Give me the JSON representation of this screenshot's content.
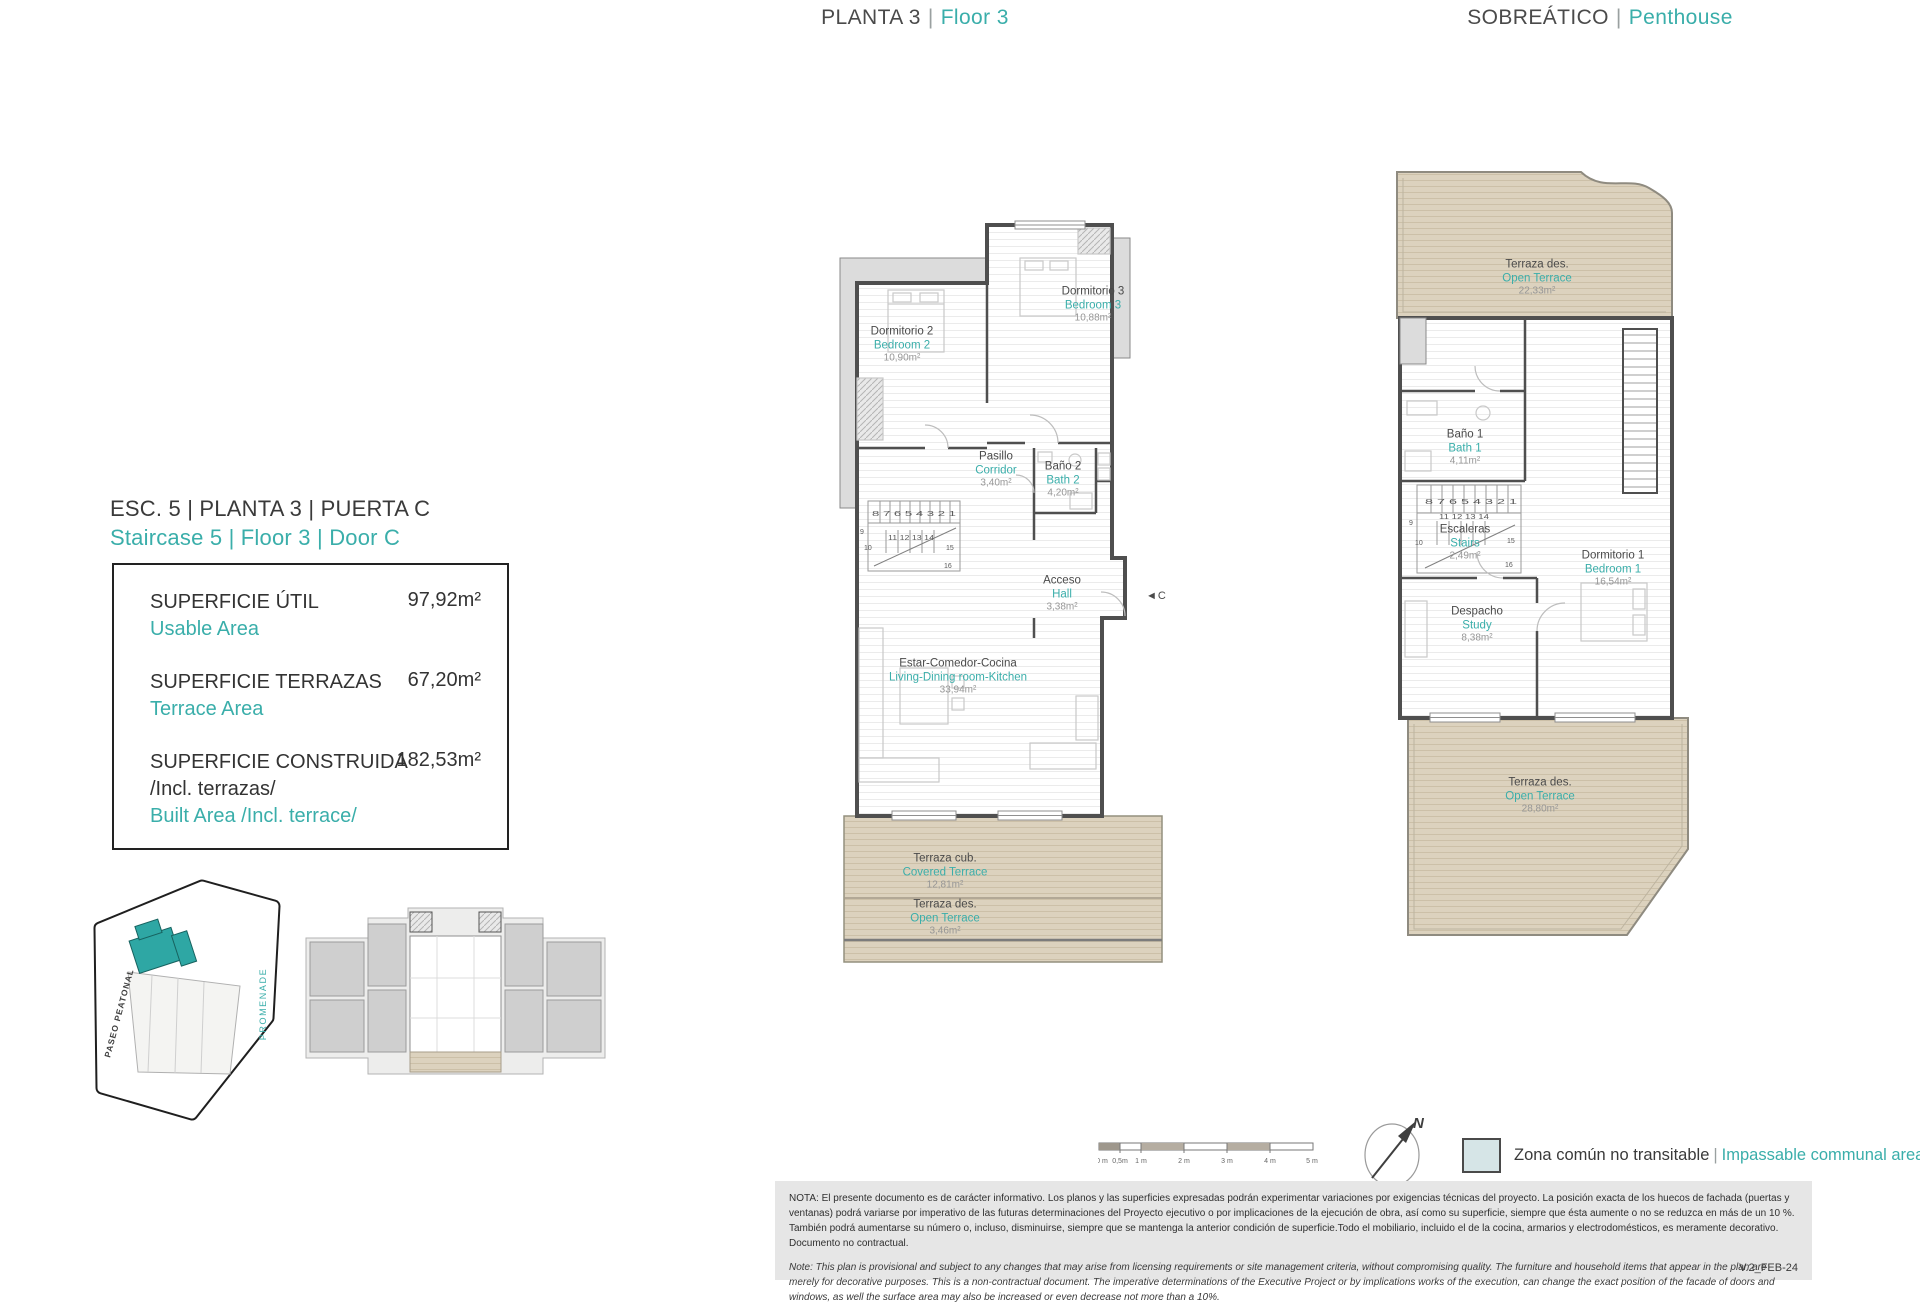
{
  "colors": {
    "accent": "#3aaeaa",
    "dark": "#3f3f3f",
    "terrace_fill": "#dcd2be",
    "communal_swatch": "#d6e5e7",
    "note_bg": "#e6e6e6"
  },
  "header": {
    "sep": "|",
    "floor3": {
      "es": "PLANTA 3",
      "en": "Floor 3"
    },
    "penthouse": {
      "es": "SOBREÁTICO",
      "en": "Penthouse"
    }
  },
  "unit": {
    "title_es": "ESC. 5 | PLANTA 3 | PUERTA C",
    "title_en": "Staircase 5 | Floor 3 | Door C"
  },
  "areas": {
    "rows": [
      {
        "es": "SUPERFICIE ÚTIL",
        "es2": "",
        "en": "Usable Area",
        "value": "97,92m²"
      },
      {
        "es": "SUPERFICIE TERRAZAS",
        "es2": "",
        "en": "Terrace Area",
        "value": "67,20m²"
      },
      {
        "es": "SUPERFICIE CONSTRUIDA",
        "es2": "/Incl. terrazas/",
        "en": "Built Area /Incl. terrace/",
        "value": "182,53m²"
      }
    ]
  },
  "floor3": {
    "rooms": [
      {
        "es": "Dormitorio 2",
        "en": "Bedroom 2",
        "area": "10,90m²"
      },
      {
        "es": "Dormitorio 3",
        "en": "Bedroom 3",
        "area": "10,88m²"
      },
      {
        "es": "Pasillo",
        "en": "Corridor",
        "area": "3,40m²"
      },
      {
        "es": "Baño 2",
        "en": "Bath 2",
        "area": "4,20m²"
      },
      {
        "es": "Acceso",
        "en": "Hall",
        "area": "3,38m²"
      },
      {
        "es": "Estar-Comedor-Cocina",
        "en": "Living-Dining room-Kitchen",
        "area": "33,94m²"
      },
      {
        "es": "Terraza cub.",
        "en": "Covered Terrace",
        "area": "12,81m²"
      },
      {
        "es": "Terraza des.",
        "en": "Open Terrace",
        "area": "3,46m²"
      }
    ]
  },
  "penthouse": {
    "rooms": [
      {
        "es": "Terraza des.",
        "en": "Open Terrace",
        "area": "22,33m²"
      },
      {
        "es": "Baño 1",
        "en": "Bath 1",
        "area": "4,11m²"
      },
      {
        "es": "Escaleras",
        "en": "Stairs",
        "area": "2,49m²"
      },
      {
        "es": "Dormitorio 1",
        "en": "Bedroom 1",
        "area": "16,54m²"
      },
      {
        "es": "Despacho",
        "en": "Study",
        "area": "8,38m²"
      },
      {
        "es": "Terraza des.",
        "en": "Open Terrace",
        "area": "28,80m²"
      }
    ]
  },
  "stairs": {
    "row_top": "8 7 6 5 4 3 2 1",
    "n9": "9",
    "row_mid": "11 12 13 14",
    "n10": "10",
    "n15": "15",
    "n16": "16"
  },
  "entrance_marker": "◄C",
  "site_plan": {
    "promenade": "PROMENADE",
    "paseo": "PASEO PEATONAL"
  },
  "scale_bar": {
    "labels": [
      "0 m",
      "0,5m",
      "1 m",
      "2 m",
      "3 m",
      "4 m",
      "5 m"
    ]
  },
  "compass": {
    "label": "N"
  },
  "legend": {
    "es": "Zona común no transitable",
    "sep": "|",
    "en": "Impassable communal area"
  },
  "notes": {
    "es": "NOTA:  El presente documento es de carácter informativo. Los planos y las superficies expresadas podrán experimentar variaciones por exigencias técnicas del proyecto. La posición exacta de los huecos de fachada (puertas y ventanas) podrá variarse por imperativo de las futuras determinaciones del Proyecto ejecutivo o por implicaciones de la ejecución de obra, así como su superficie, siempre que ésta aumente o no se reduzca en más de un 10 %. También podrá aumentarse su número o, incluso, disminuirse, siempre que se mantenga la anterior condición de superficie.Todo el mobiliario, incluido el de la cocina, armarios y electrodomésticos, es meramente decorativo. Documento no contractual.",
    "en": "Note: This plan is provisional and subject to any changes that may arise from licensing requirements or site management criteria, without compromising quality. The furniture and household items that appear in the plan are merely for decorative purposes. This is a non-contractual document. The imperative determinations of the Executive Project or by implications works of the execution, can change the exact position of the facade of doors and windows, as well the surface area may also be increased or even decrease not more than a 10%.",
    "version": "V.2_FEB-24"
  }
}
